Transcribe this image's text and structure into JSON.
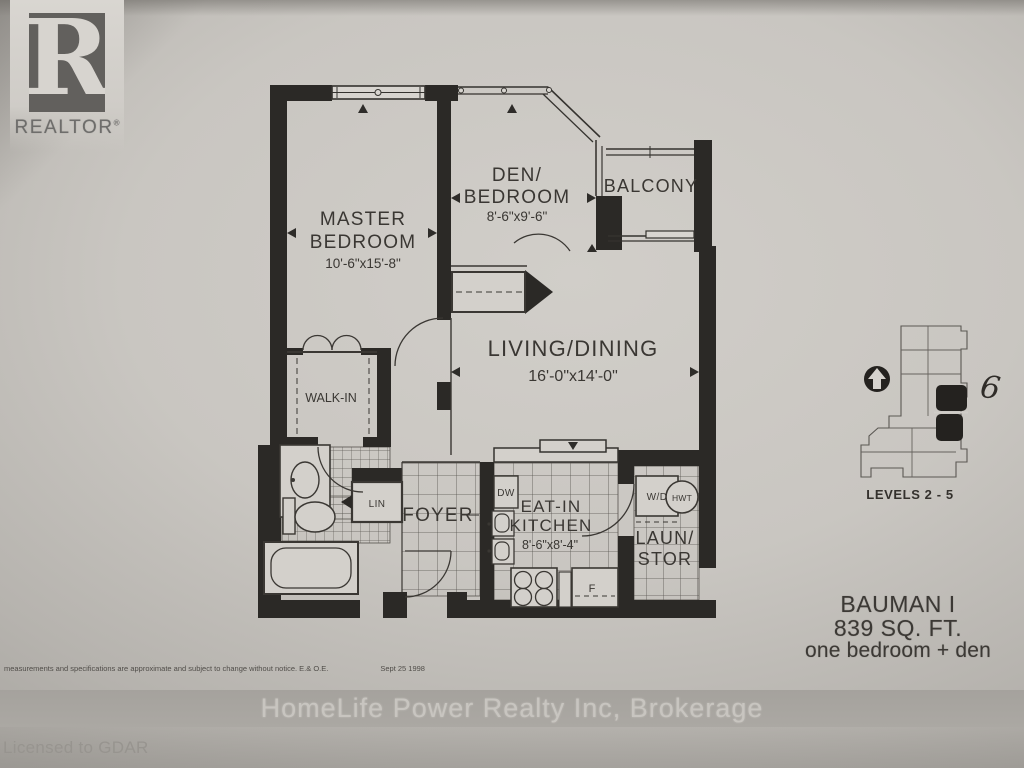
{
  "branding": {
    "logo_letter": "R",
    "logo_word": "REALTOR",
    "logo_reg": "®",
    "licensed": "Licensed to GDAR",
    "watermark": "HomeLife Power Realty Inc, Brokerage"
  },
  "rooms": {
    "master": {
      "line1": "MASTER",
      "line2": "BEDROOM",
      "dims": "10'-6\"x15'-8\""
    },
    "den": {
      "line1": "DEN/",
      "line2": "BEDROOM",
      "dims": "8'-6\"x9'-6\""
    },
    "balcony": {
      "line1": "BALCONY"
    },
    "living": {
      "line1": "LIVING/DINING",
      "dims": "16'-0\"x14'-0\""
    },
    "walkin": {
      "line1": "WALK-IN"
    },
    "foyer": {
      "line1": "FOYER"
    },
    "kitchen": {
      "line1": "EAT-IN",
      "line2": "KITCHEN",
      "dims": "8'-6\"x8'-4\""
    },
    "laundry": {
      "line1": "LAUN/",
      "line2": "STOR"
    }
  },
  "fixtures": {
    "lin": "LIN",
    "dw": "DW",
    "wd": "W/D",
    "hwt": "HWT",
    "fridge": "F"
  },
  "keyplan": {
    "unit": "6",
    "levels": "LEVELS 2 - 5"
  },
  "title_block": {
    "model": "BAUMAN I",
    "area": "839 SQ. FT.",
    "type": "one bedroom + den"
  },
  "disclaimer": {
    "text": "measurements and specifications are approximate and subject to change without notice.  E.& O.E.",
    "date": "Sept 25 1998"
  },
  "colors": {
    "ink": "#3a3733",
    "wall": "#2b2926",
    "paper": "#d3d0cb",
    "band": "#a7a4a0"
  }
}
